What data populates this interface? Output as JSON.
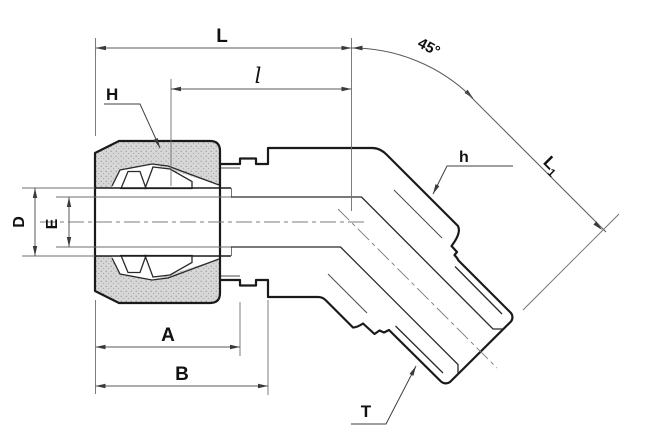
{
  "drawing": {
    "kind": "dimensioned engineering drawing",
    "angle_value": "45°"
  },
  "labels": {
    "overall_length": "L",
    "insertion_to_center": "l",
    "angle": "45°",
    "angled_leg_base": "L",
    "angled_leg_sub": "1",
    "nut_hex": "H",
    "body_hex": "h",
    "tube_hole_dia": "D",
    "bore_dia": "E",
    "nut_length": "A",
    "body_length": "B",
    "thread": "T"
  },
  "colors": {
    "background": "#ffffff",
    "body_fill": "#e9e9e9",
    "nut_fill": "#d7d7d7",
    "ferrule_fill": "#e3e3e3",
    "outline": "#1a1a1a",
    "dimension": "#5a5a5a"
  }
}
